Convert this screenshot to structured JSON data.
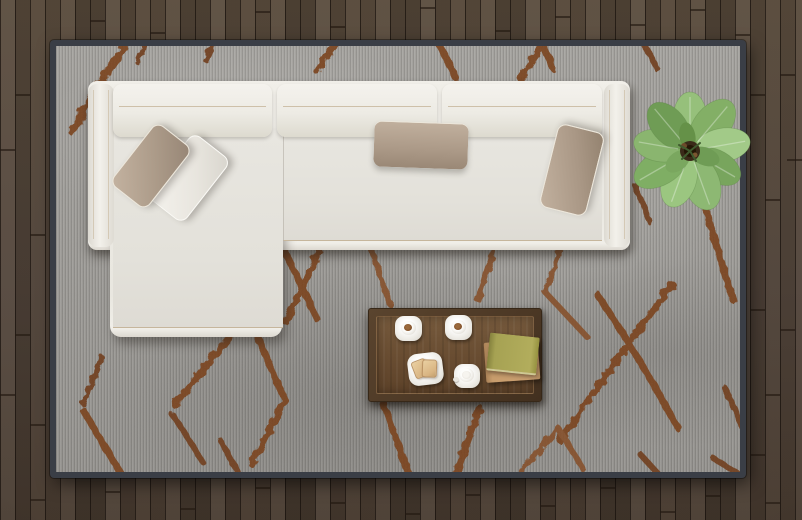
{
  "scene": {
    "title": "Top view of a modern living room",
    "view": "top-down 3D render",
    "room": {
      "floor": {
        "name": "wood-plank-floor",
        "material": "dark wood planks, vertical orientation",
        "color": "#51443a",
        "gap_color": "#241a12"
      },
      "rug": {
        "name": "area-rug",
        "base_color": "#a09e9a",
        "edge_color": "#3a3e46",
        "pattern": "hand-drawn rust diamond trellis lines",
        "pattern_color": "#7a431f",
        "bbox": [
          50,
          40,
          696,
          438
        ]
      }
    },
    "objects": [
      {
        "name": "sectional-sofa",
        "description": "white L-shaped sectional with chaise on left",
        "color": "#ebe9e3",
        "back_cushions": 3,
        "bbox": [
          88,
          81,
          542,
          256
        ]
      },
      {
        "name": "pillow-taupe-left",
        "color": "#ac9b89",
        "bbox": [
          113,
          122,
          77,
          88
        ]
      },
      {
        "name": "pillow-white-left",
        "color": "#ece9e2",
        "bbox": [
          150,
          133,
          75,
          89
        ]
      },
      {
        "name": "pillow-taupe-middle",
        "color": "#ab9987",
        "bbox": [
          374,
          121,
          94,
          47
        ]
      },
      {
        "name": "pillow-taupe-right",
        "color": "#a99785",
        "bbox": [
          543,
          121,
          60,
          97
        ]
      },
      {
        "name": "coffee-table",
        "description": "rectangular walnut coffee table",
        "color": "#684c31",
        "bbox": [
          368,
          308,
          174,
          94
        ]
      },
      {
        "name": "espresso-cup-left",
        "contents": "coffee",
        "bbox": [
          394,
          314,
          27,
          26
        ]
      },
      {
        "name": "espresso-cup-right",
        "contents": "coffee",
        "bbox": [
          444,
          313,
          27,
          26
        ]
      },
      {
        "name": "toast-plate",
        "contents": "two toast slices",
        "bbox": [
          407,
          352,
          35,
          32
        ]
      },
      {
        "name": "milk-cup",
        "contents": "milk",
        "bbox": [
          453,
          363,
          26,
          24
        ]
      },
      {
        "name": "books",
        "count": 2,
        "colors": [
          "#b2ad5c",
          "#c79c6c"
        ],
        "bbox": [
          486,
          335,
          52,
          44
        ]
      },
      {
        "name": "potted-plant",
        "description": "broad-leaf green plant",
        "leaf_color": "#8db872",
        "bbox": [
          632,
          96,
          116,
          114
        ]
      }
    ]
  },
  "palette": {
    "floor_wood": "#51443a",
    "rug_gray": "#a09e9a",
    "rug_border": "#3a3e46",
    "rug_pattern_rust": "#7a431f",
    "sofa_white": "#ebe9e3",
    "piping_tan": "#c6b69c",
    "pillow_taupe": "#ac9b89",
    "table_wood": "#684c31",
    "book_olive": "#b2ad5c",
    "book_tan": "#c79c6c",
    "plant_green": "#8db872"
  }
}
